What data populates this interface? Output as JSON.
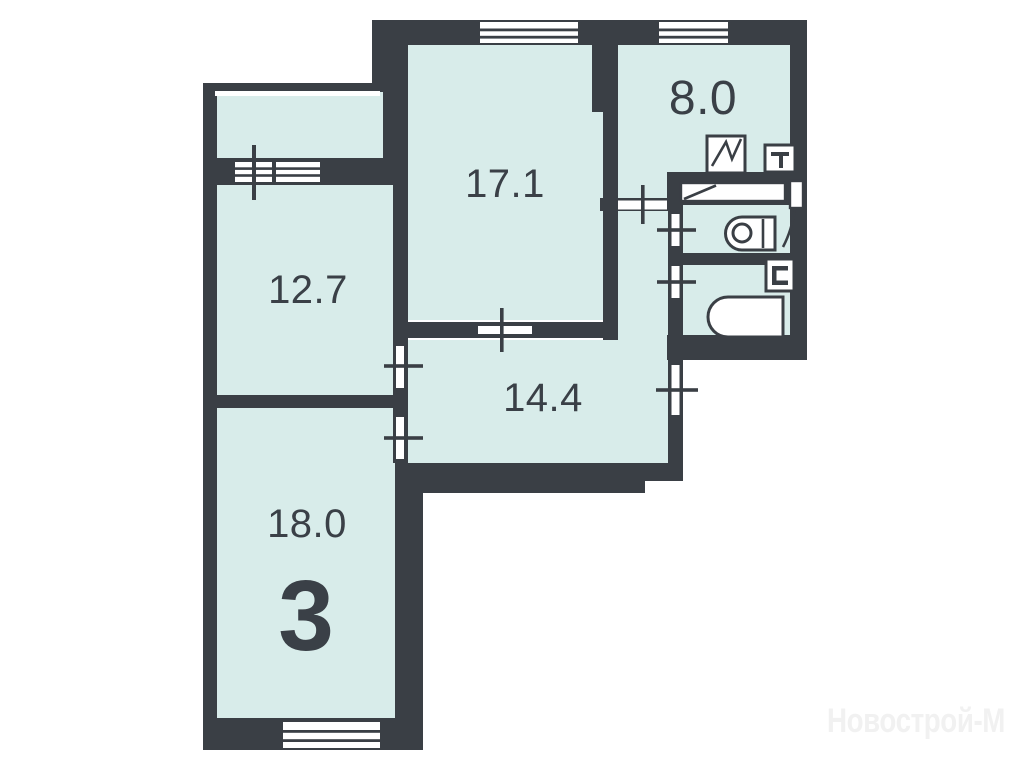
{
  "plan": {
    "type": "apartment-floor-plan",
    "apartment_rooms_label": "3",
    "rooms": {
      "kitchen": {
        "name": "kitchen",
        "area": "8.0"
      },
      "living_room": {
        "name": "living-room",
        "area": "17.1"
      },
      "bedroom_small": {
        "name": "bedroom-small",
        "area": "12.7"
      },
      "hallway": {
        "name": "hallway",
        "area": "14.4"
      },
      "bedroom_large": {
        "name": "bedroom-large",
        "area": "18.0"
      },
      "balcony": {
        "name": "balcony"
      },
      "wc": {
        "name": "wc"
      },
      "bathroom": {
        "name": "bathroom"
      }
    },
    "fixtures": [
      "stove",
      "kitchen-sink",
      "toilet",
      "bathtub",
      "washbasin"
    ],
    "windows": [
      "living-room-window",
      "kitchen-window",
      "balcony-window-block",
      "bedroom-large-window"
    ],
    "doors": [
      "balcony-door",
      "kitchen-door",
      "wc-door",
      "bathroom-door",
      "entry-door",
      "living-room-door",
      "bedroom-small-door",
      "bedroom-large-door"
    ]
  },
  "watermark": {
    "text": "Новострой-М"
  },
  "colors": {
    "wall": "#3a3f45",
    "floor": "#d8ecea",
    "background": "#ffffff",
    "label": "#3a4047",
    "watermark": "#f1f1f1"
  }
}
